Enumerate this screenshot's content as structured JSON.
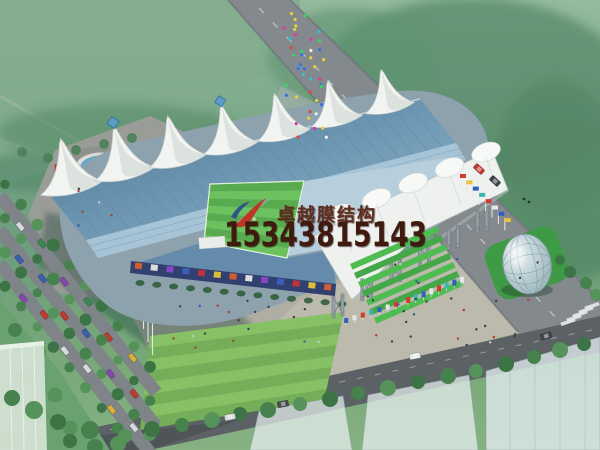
{
  "image": {
    "type": "architectural rendering",
    "subject": "Aerial perspective rendering of a tensile-membrane roof stadium complex",
    "width_px": 600,
    "height_px": 450
  },
  "watermark": {
    "brand_name": "卓越膜结构",
    "phone_number": "15343815143",
    "logo": "red-swoosh-logo",
    "brand_color": "#5f2d1f",
    "phone_color": "#401a0e"
  },
  "scene": {
    "stadium": {
      "membrane_tent_peaks": 7,
      "east_canopy_peaks": 5,
      "canopy_pylons": 6,
      "pitch_stripes": 8,
      "entrance_terrace_steps": 7
    },
    "features": [
      "fountain-plaza",
      "tree-lined-parking-avenue",
      "glass-dome-pavilion",
      "pedestrian-plaza",
      "flag-rows",
      "ghost-buildings",
      "main-road",
      "south-road",
      "zebra-crossing",
      "crowd-crossing-road",
      "stadium-shadow"
    ]
  },
  "palette": {
    "haze_green_top": "#95bb9e",
    "lawn_green": "#82ab8d",
    "tree_green_dark": "#3c7446",
    "tree_green_mid": "#47814d",
    "tree_green_light": "#55935a",
    "pitch_green_dark": "#58ab4e",
    "pitch_green_light": "#6cc25f",
    "south_lawn_green": "#74ae58",
    "south_lawn_light": "#8ac468",
    "roof_blue_dark": "#49748f",
    "roof_blue_light": "#8fb6cc",
    "seat_blue": "#a6c4d6",
    "membrane_white": "#f2f4f1",
    "road_gray": "#83898d",
    "south_road_gray": "#5b6165",
    "plaza_gray": "#bcb9ad",
    "ad_wall_blue": "#31406f",
    "terrace_green_a": "#4fbc51",
    "terrace_green_b": "#45a848",
    "water_blue": "#5fa8cd",
    "car_red": "#c23a2e"
  }
}
